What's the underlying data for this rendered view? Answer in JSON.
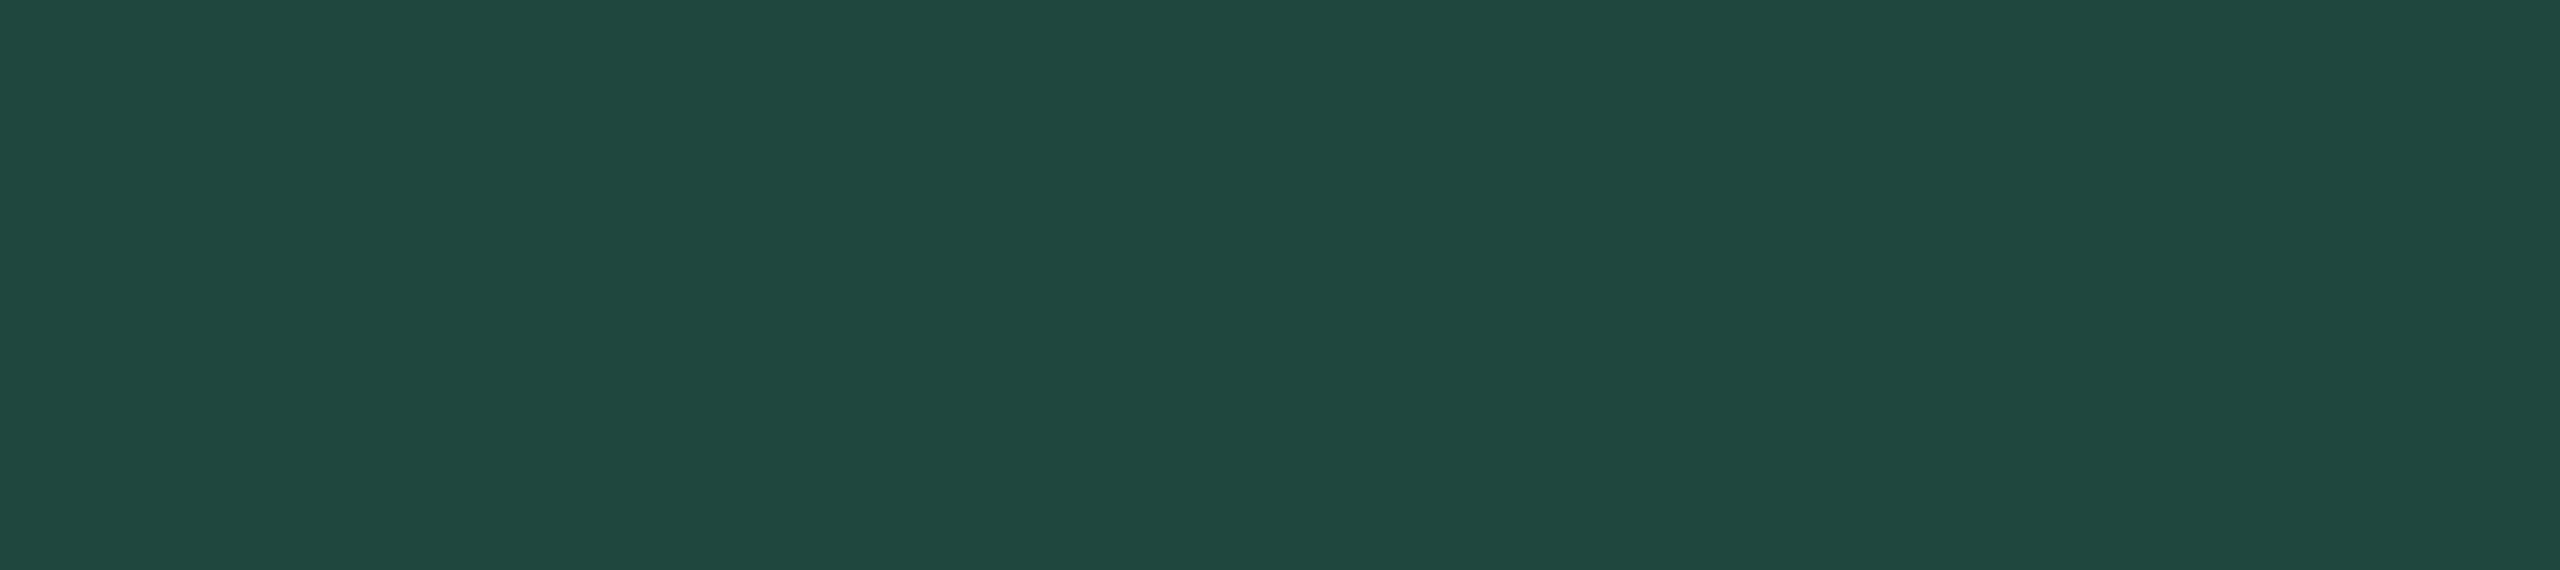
{
  "screen": {
    "background_color": "#1d473c"
  }
}
